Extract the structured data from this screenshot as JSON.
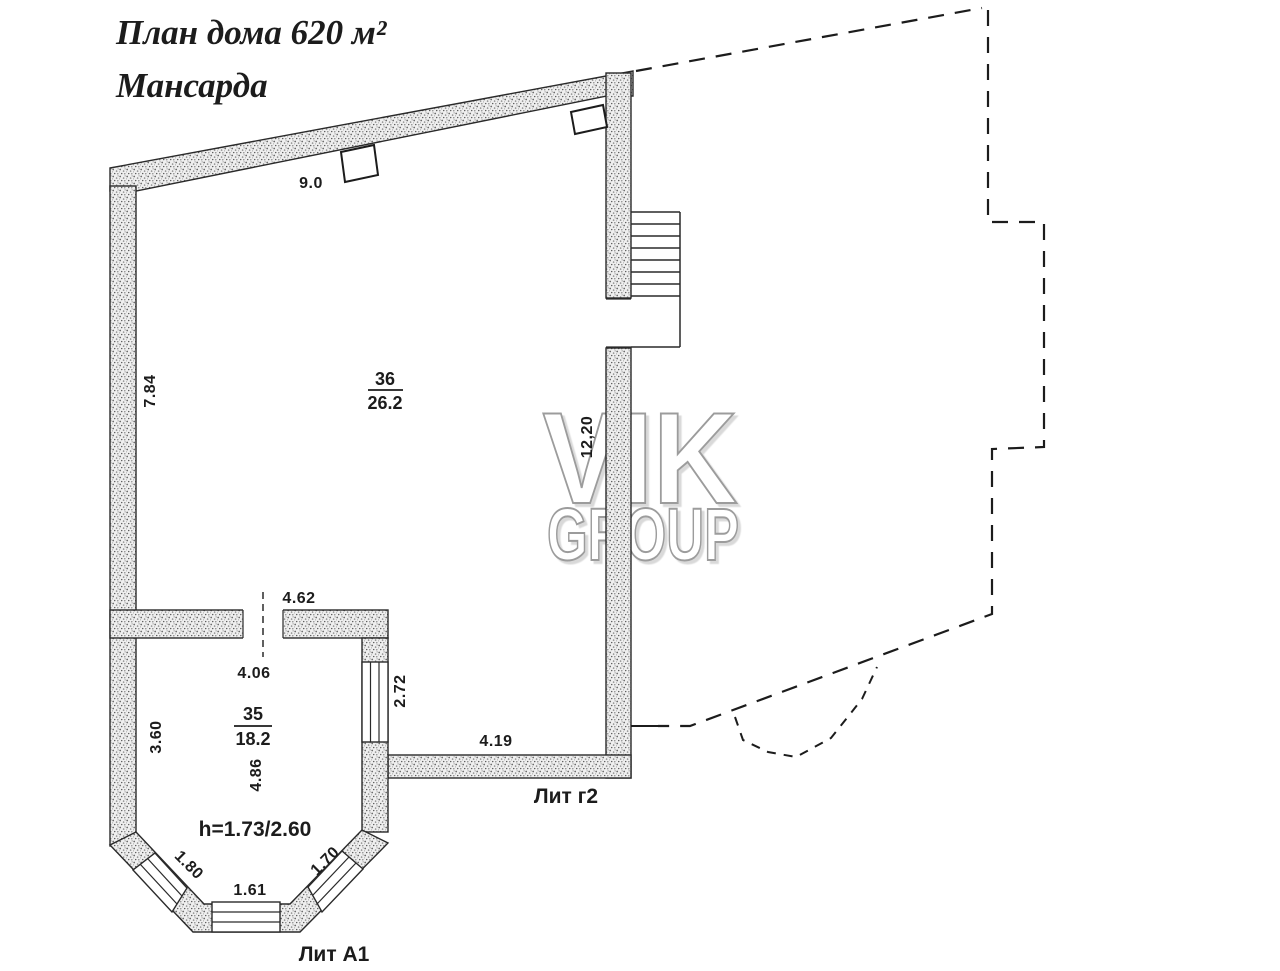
{
  "title": {
    "line1": "План дома 620 м²",
    "line2": "Мансарда"
  },
  "watermark": {
    "line1": "VIK",
    "line2": "GROUP"
  },
  "rooms": {
    "r36": {
      "number": "36",
      "area": "26.2"
    },
    "r35": {
      "number": "35",
      "area": "18.2"
    }
  },
  "dimensions": {
    "top_wall": "9.0",
    "left_wall": "7.84",
    "right_wall_inner": "12,20",
    "r35_top_outer": "4.62",
    "r35_top_inner": "4.06",
    "r35_left": "3.60",
    "r35_vertical": "4.86",
    "r35_right_window": "2.72",
    "g2_bottom": "4.19",
    "bay_left_window": "1.80",
    "bay_bottom_window": "1.61",
    "bay_right_window": "1.70"
  },
  "annotations": {
    "ceiling_height": "h=1.73/2.60",
    "lit_g2": "Лит г2",
    "lit_a1": "Лит А1"
  },
  "colors": {
    "ink": "#1c1c1c",
    "wall_fill_speckle": "#6f6f6f",
    "watermark_outline": "#9c9c9c",
    "background": "#ffffff"
  }
}
